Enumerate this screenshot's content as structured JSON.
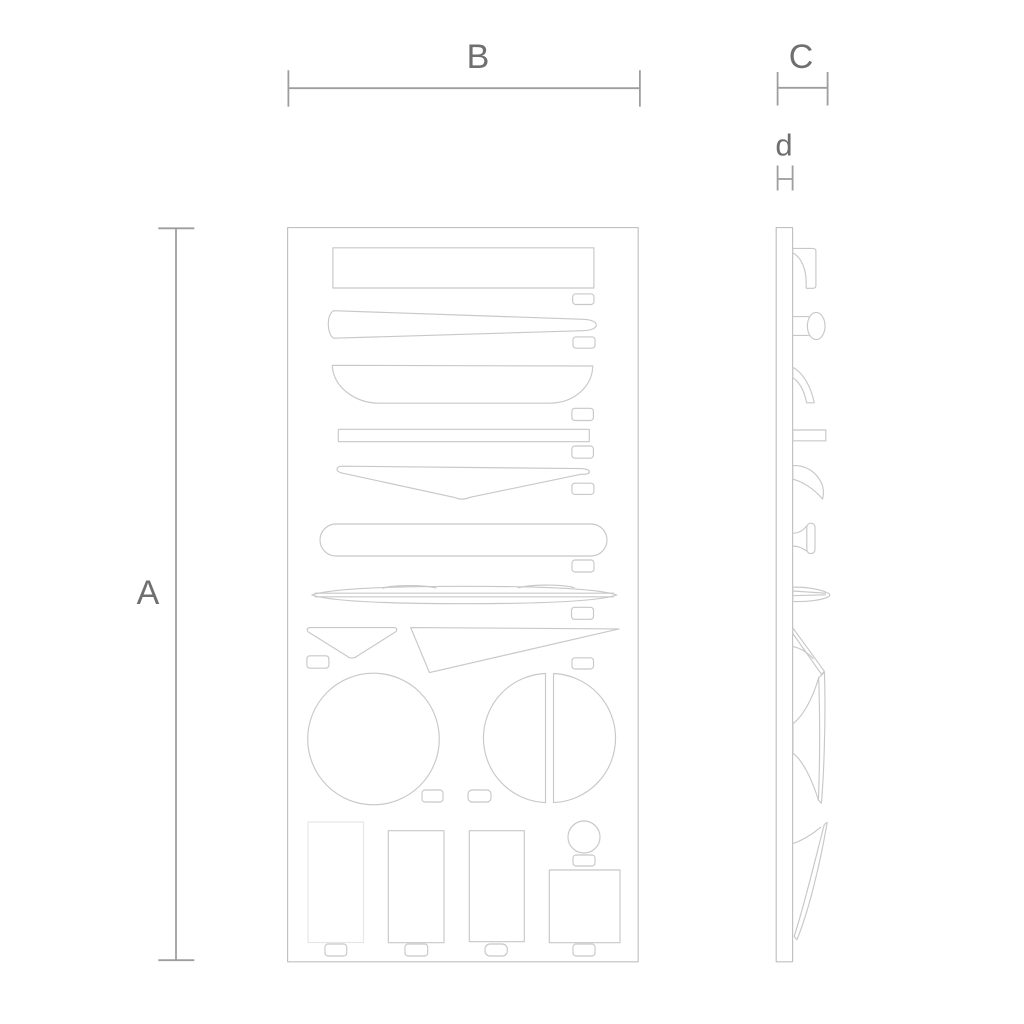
{
  "dimension_labels": {
    "height": "A",
    "width": "B",
    "depth": "C",
    "thickness": "d"
  },
  "colors": {
    "background": "#ffffff",
    "outline": "#c8c8c8",
    "panel_outline": "#c0c0c0",
    "outline_faint": "#e6e6e6",
    "dimension_line": "#9e9e9e",
    "label_text": "#6f6f6f"
  }
}
